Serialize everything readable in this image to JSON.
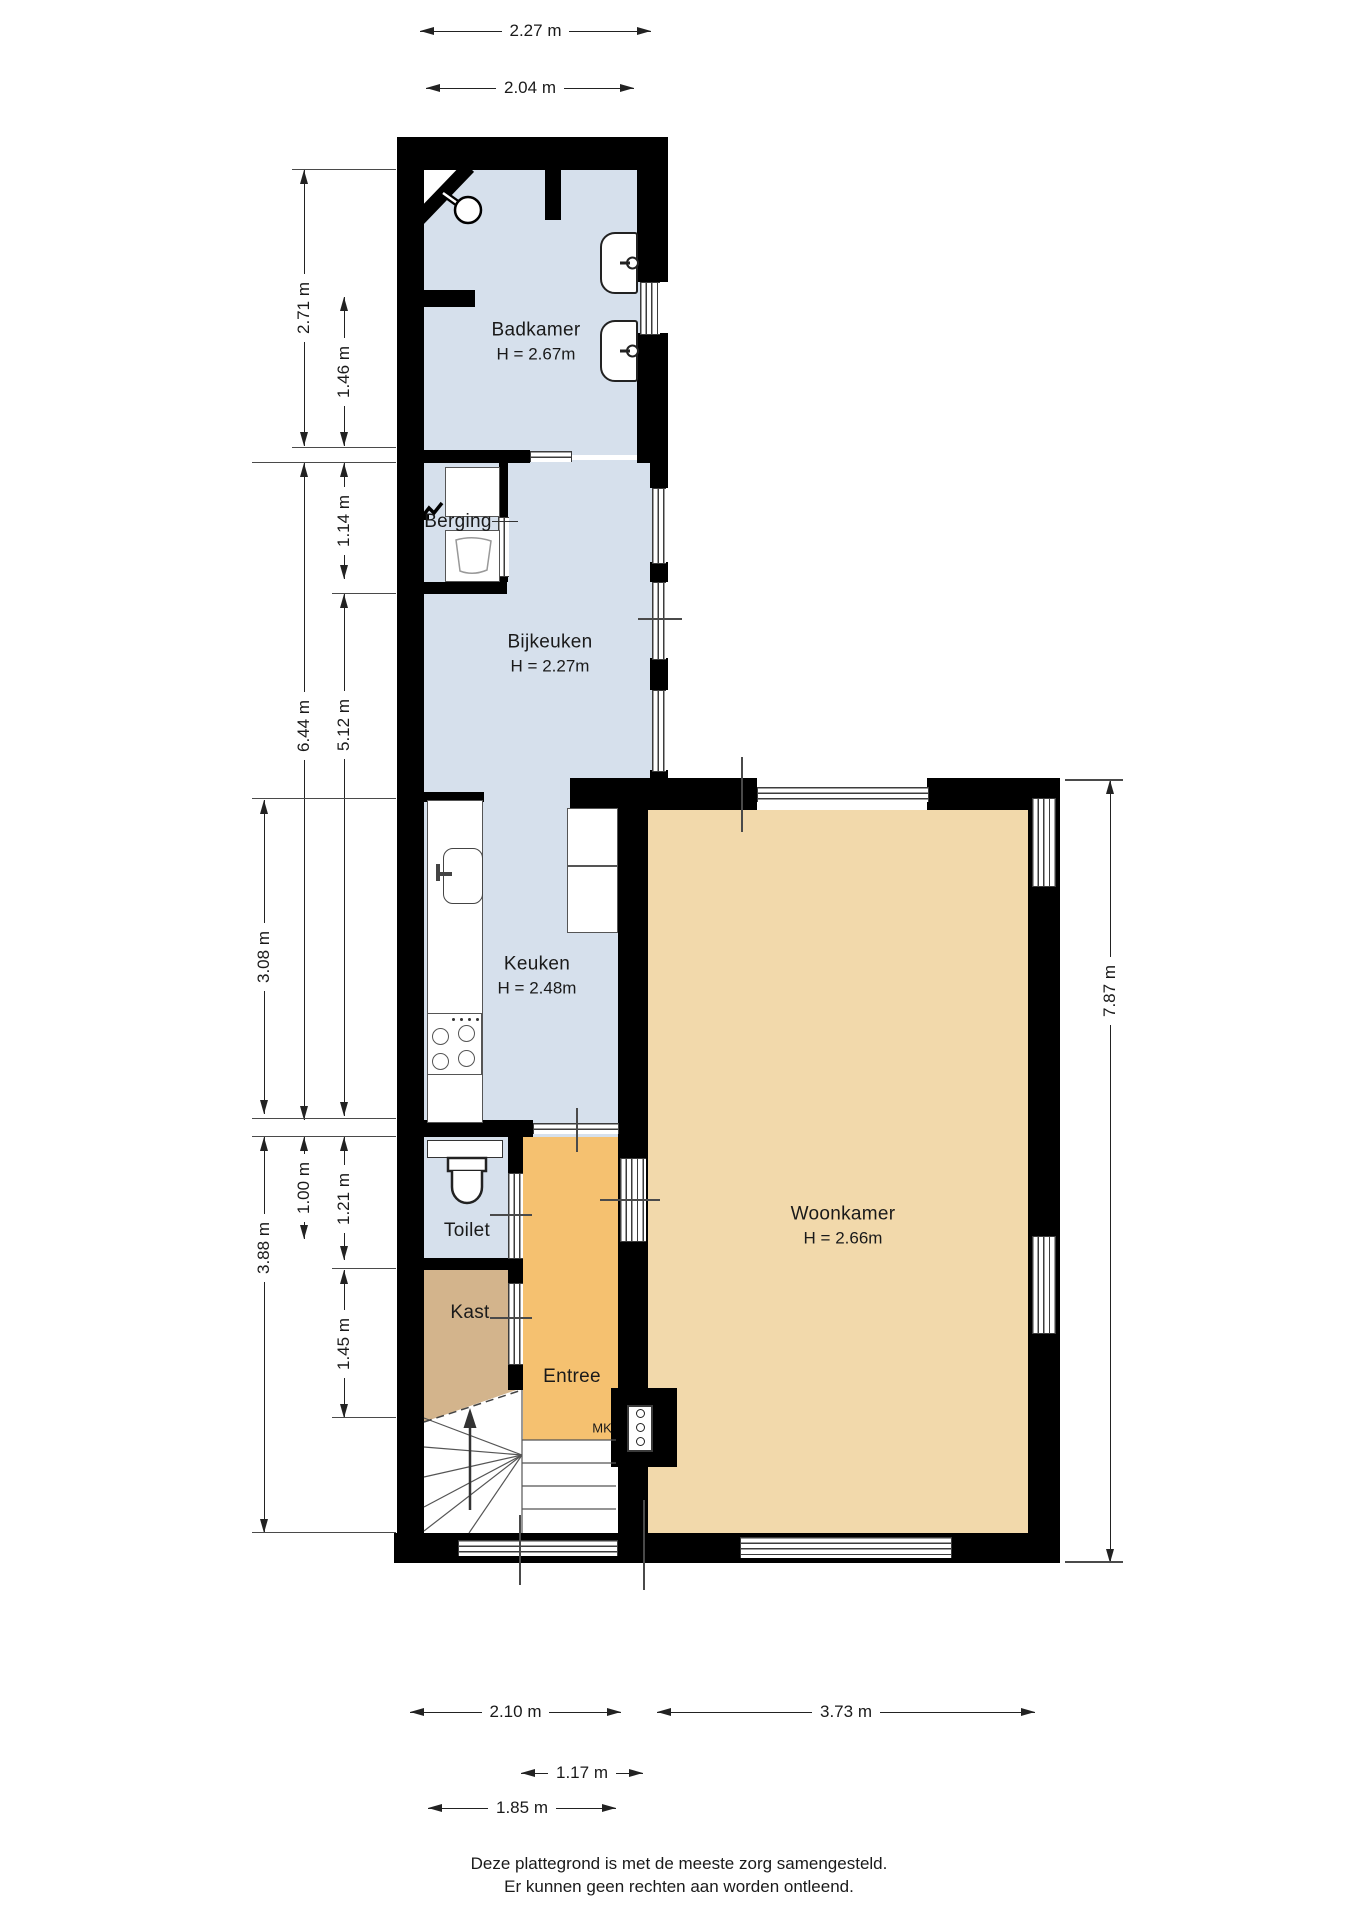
{
  "rooms": {
    "badkamer": {
      "name": "Badkamer",
      "height": "H = 2.67m"
    },
    "berging": {
      "name": "Berging"
    },
    "bijkeuken": {
      "name": "Bijkeuken",
      "height": "H = 2.27m"
    },
    "keuken": {
      "name": "Keuken",
      "height": "H = 2.48m"
    },
    "toilet": {
      "name": "Toilet"
    },
    "kast": {
      "name": "Kast"
    },
    "entree": {
      "name": "Entree"
    },
    "woonkamer": {
      "name": "Woonkamer",
      "height": "H = 2.66m"
    },
    "meterkast": {
      "name": "MK"
    }
  },
  "dimensions": {
    "top": {
      "d227": "2.27 m",
      "d204": "2.04 m"
    },
    "left": {
      "d271": "2.71 m",
      "d146": "1.46 m",
      "d114": "1.14 m",
      "d644": "6.44 m",
      "d512": "5.12 m",
      "d308": "3.08 m",
      "d100": "1.00 m",
      "d121": "1.21 m",
      "d388": "3.88 m",
      "d145": "1.45 m"
    },
    "right": {
      "d787": "7.87 m"
    },
    "bottom": {
      "d210": "2.10 m",
      "d373": "3.73 m",
      "d117": "1.17 m",
      "d185": "1.85 m"
    }
  },
  "footer": {
    "line1": "Deze plattegrond is met de meeste zorg samengesteld.",
    "line2": "Er kunnen geen rechten aan worden ontleend."
  },
  "colors": {
    "wet_room_floor": "#d6e0ec",
    "storage_floor": "#d3b48c",
    "hall_floor": "#f5c170",
    "living_floor": "#f2d9ab",
    "wall": "#000000"
  }
}
